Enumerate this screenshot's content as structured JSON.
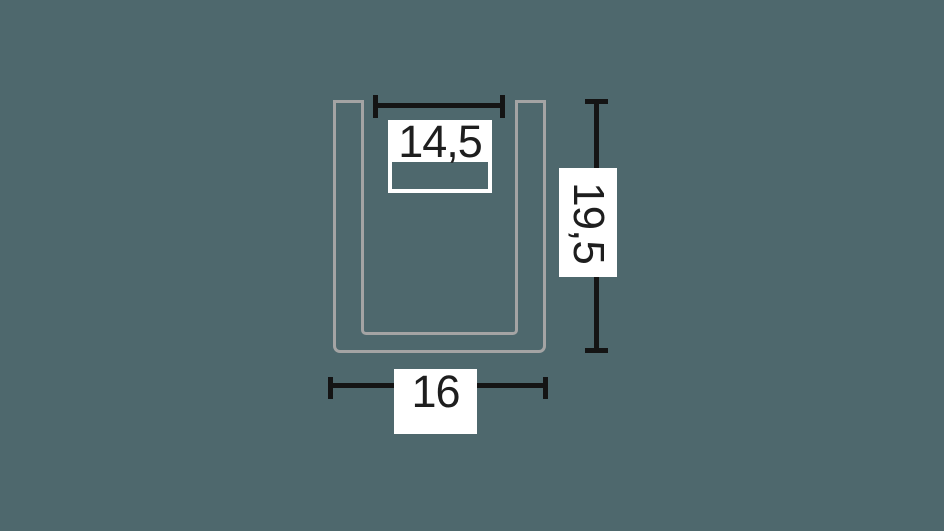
{
  "diagram": {
    "type": "technical-profile-drawing",
    "subject": "u-channel-profile-cross-section",
    "colors": {
      "background": "#4e686d",
      "profile": "#a4a4a4",
      "line": "#141414",
      "labelbg": "#ffffff",
      "text": "#1e1e1e"
    },
    "dimensions": {
      "inner_width": {
        "value": "14,5"
      },
      "height": {
        "value": "19,5"
      },
      "outer_width": {
        "value": "16"
      }
    }
  }
}
